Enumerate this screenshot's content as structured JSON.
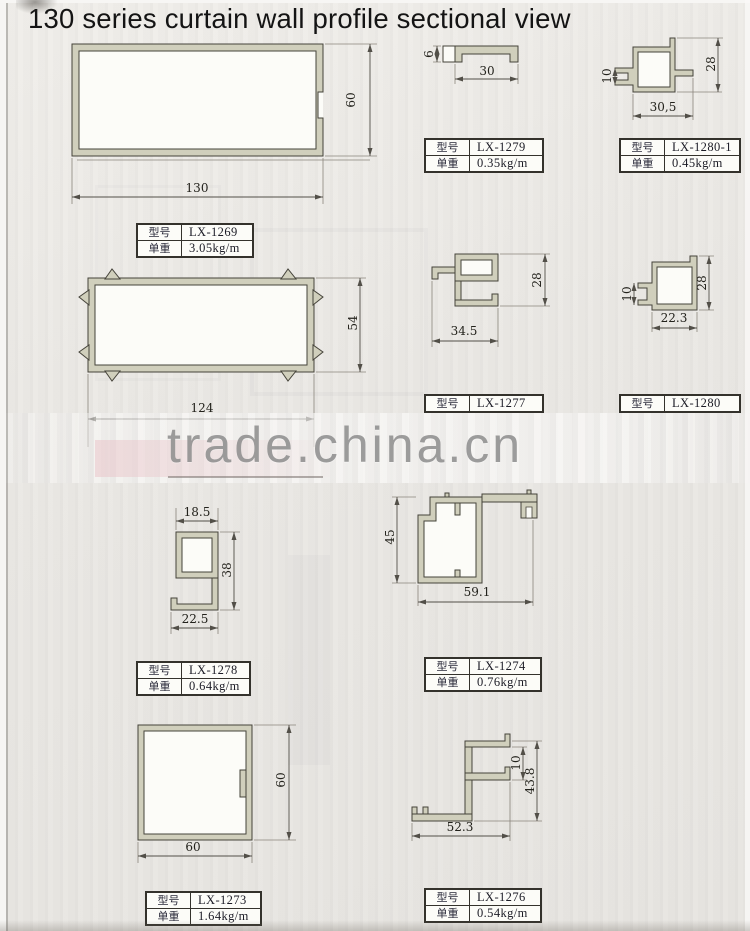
{
  "page": {
    "title": "130 series curtain wall profile sectional view",
    "watermark": "trade.china.cn"
  },
  "labels": {
    "model": "型号",
    "weight": "单重"
  },
  "profiles": {
    "lx1269": {
      "model": "LX-1269",
      "weight": "3.05kg/m",
      "dims": {
        "width": "130",
        "height": "60"
      }
    },
    "lx1279": {
      "model": "LX-1279",
      "weight": "0.35kg/m",
      "dims": {
        "width": "30",
        "height": "6"
      }
    },
    "lx1280_1": {
      "model": "LX-1280-1",
      "weight": "0.45kg/m",
      "dims": {
        "width": "30,5",
        "height": "28",
        "mouth": "10"
      }
    },
    "rect124": {
      "dims": {
        "width": "124",
        "height": "54"
      }
    },
    "lx1277": {
      "model": "LX-1277",
      "dims": {
        "width": "34.5",
        "height": "28"
      }
    },
    "lx1280": {
      "model": "LX-1280",
      "dims": {
        "width": "22.3",
        "height": "28",
        "mouth": "10"
      }
    },
    "lx1278": {
      "model": "LX-1278",
      "weight": "0.64kg/m",
      "dims": {
        "top": "18.5",
        "height": "38",
        "bottom": "22.5"
      }
    },
    "lx1274": {
      "model": "LX-1274",
      "weight": "0.76kg/m",
      "dims": {
        "width": "59.1",
        "height": "45"
      }
    },
    "lx1273": {
      "model": "LX-1273",
      "weight": "1.64kg/m",
      "dims": {
        "width": "60",
        "height": "60"
      }
    },
    "lx1276": {
      "model": "LX-1276",
      "weight": "0.54kg/m",
      "dims": {
        "width": "52.3",
        "height": "43.8",
        "step": "10"
      }
    }
  },
  "colors": {
    "profile_fill": "#d0cfbc",
    "line": "#45433a",
    "paper": "#eae8e4",
    "watermark": "#8d8d8d"
  }
}
